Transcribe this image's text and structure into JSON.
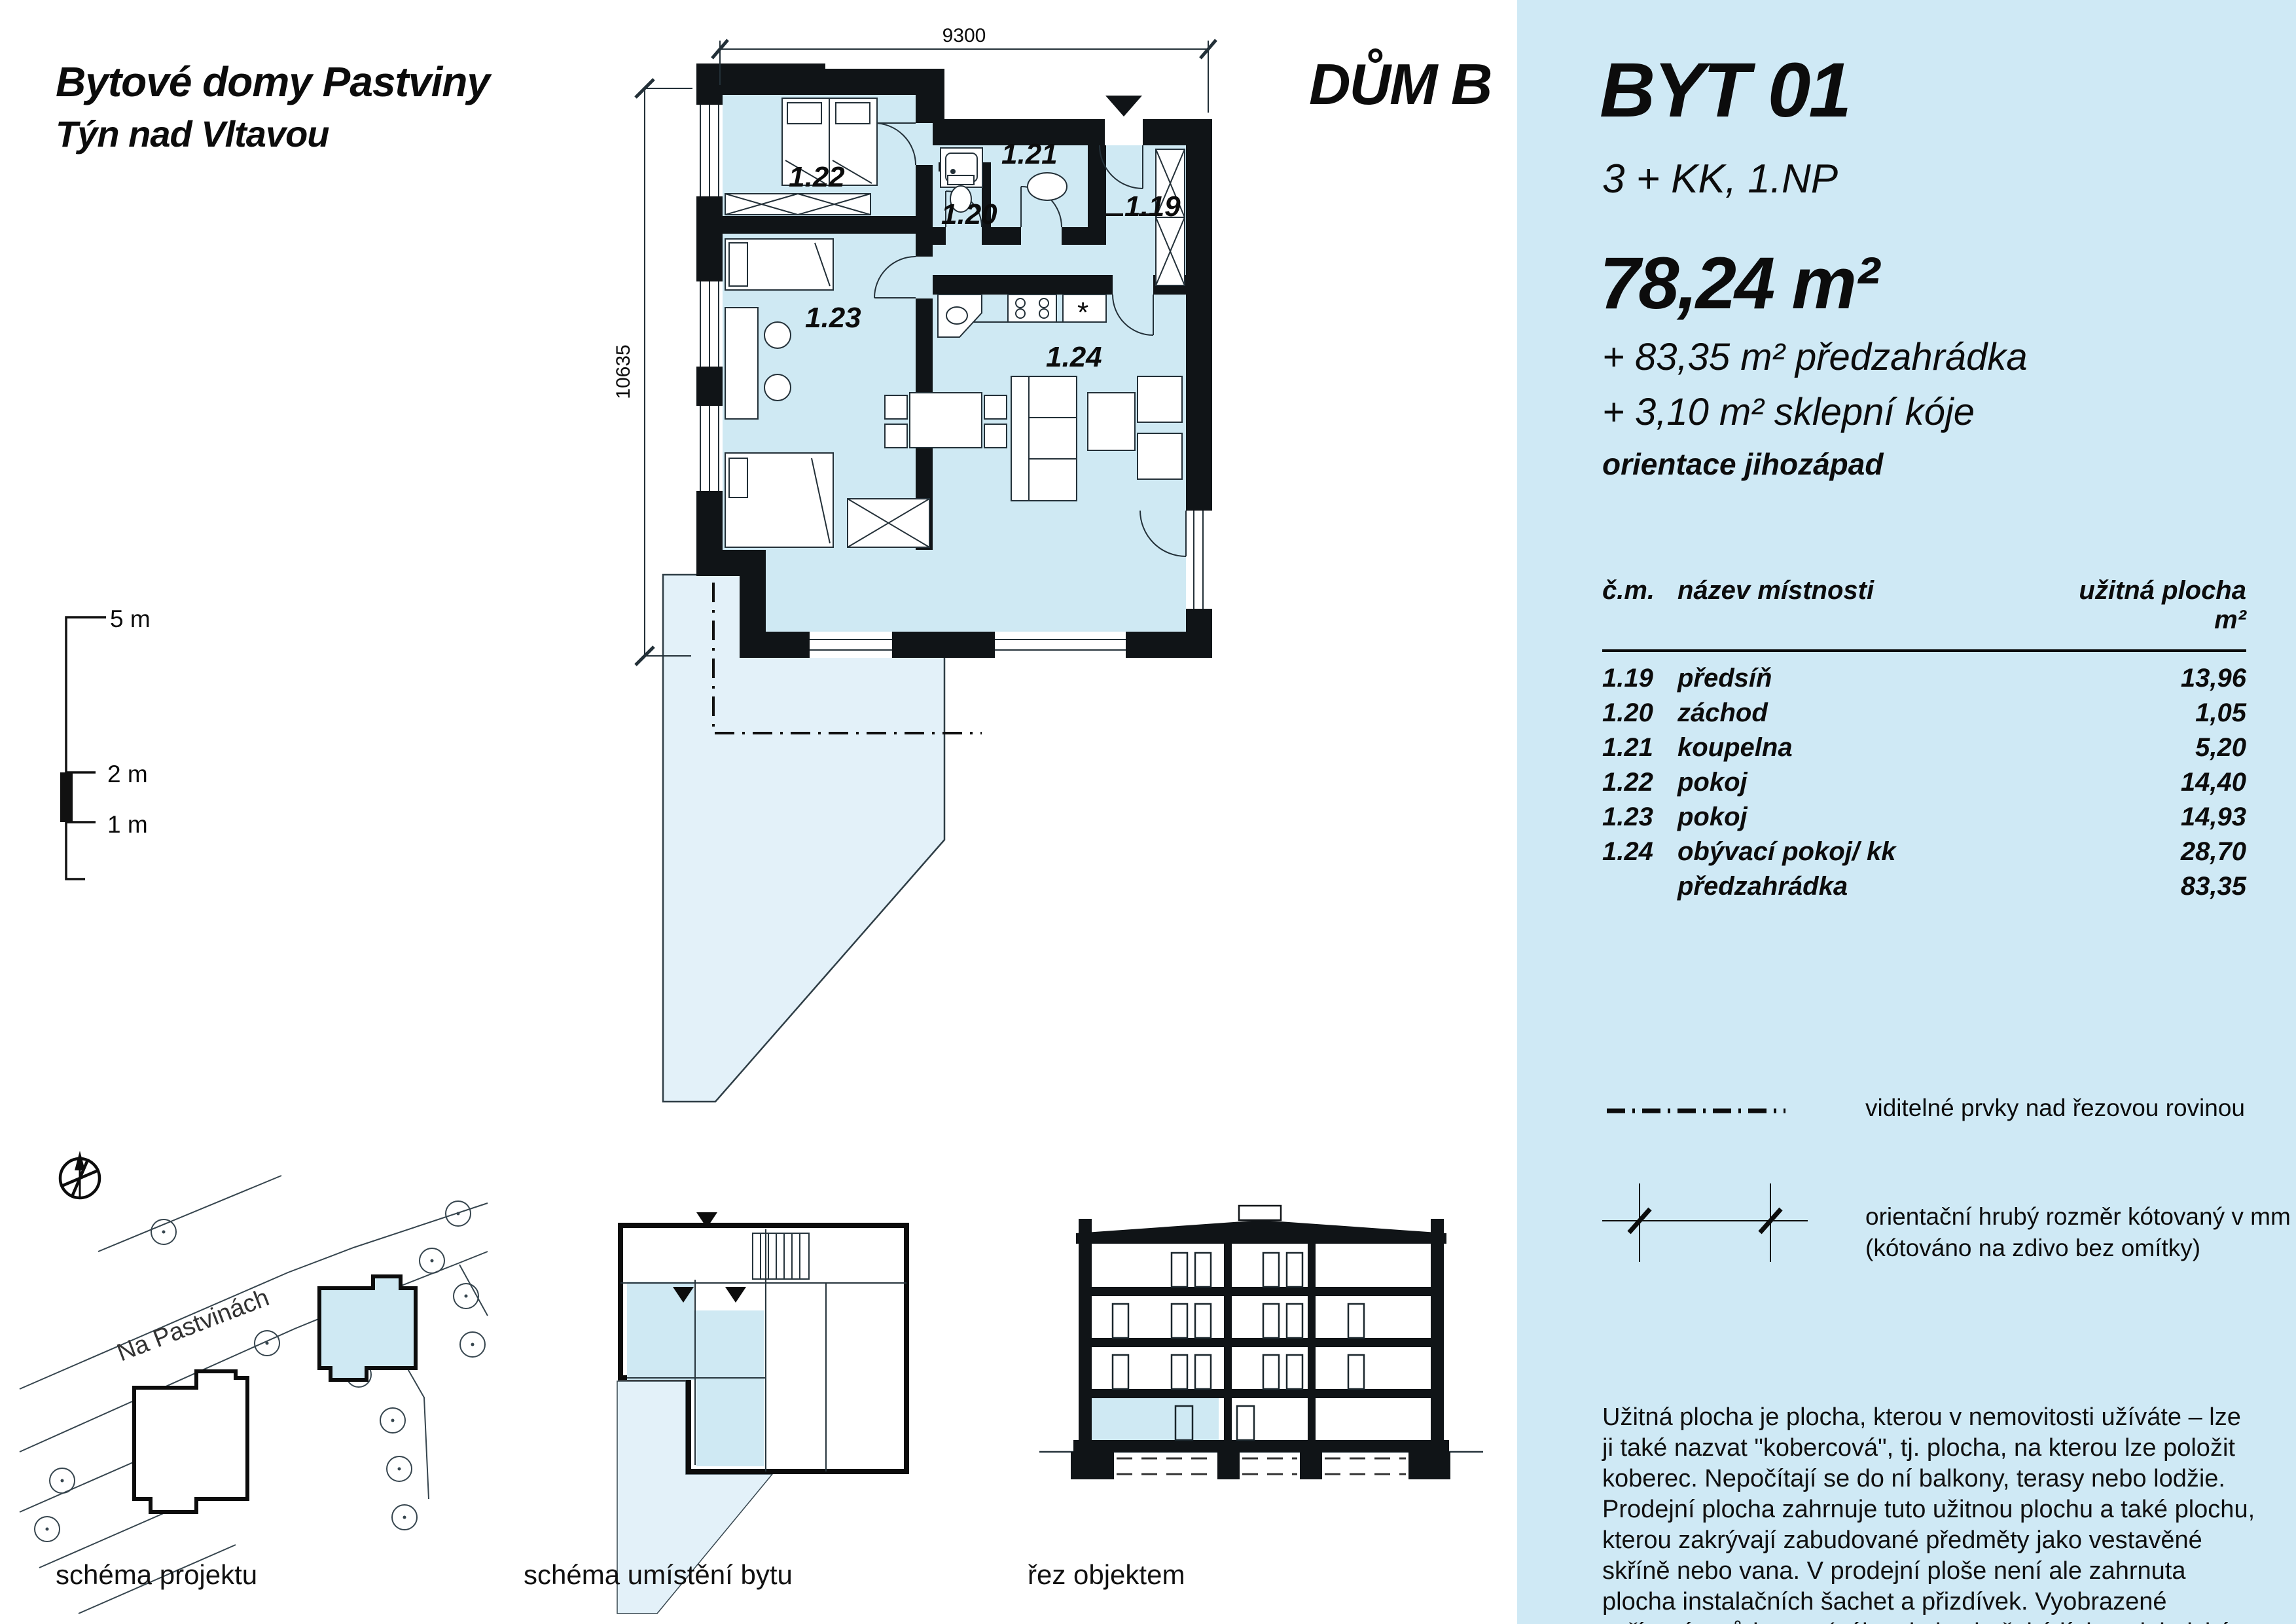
{
  "header": {
    "project_title": "Bytové domy Pastviny",
    "project_subtitle": "Týn nad Vltavou",
    "building_label": "DŮM B"
  },
  "panel": {
    "flat_id": "BYT 01",
    "flat_layout": "3 + KK, 1.NP",
    "area_main": "78,24 m²",
    "area_garden": "+ 83,35 m² předzahrádka",
    "area_cellar": "+ 3,10 m² sklepní kóje",
    "orientation": "orientace jihozápad",
    "table": {
      "headers": [
        "č.m.",
        "název místnosti",
        "užitná plocha m²"
      ],
      "rows": [
        [
          "1.19",
          "předsíň",
          "13,96"
        ],
        [
          "1.20",
          "záchod",
          "1,05"
        ],
        [
          "1.21",
          "koupelna",
          "5,20"
        ],
        [
          "1.22",
          "pokoj",
          "14,40"
        ],
        [
          "1.23",
          "pokoj",
          "14,93"
        ],
        [
          "1.24",
          "obývací pokoj/ kk",
          "28,70"
        ],
        [
          "",
          "předzahrádka",
          "83,35"
        ]
      ]
    },
    "legend": [
      {
        "label": "viditelné prvky nad řezovou rovinou"
      },
      {
        "label": "orientační hrubý rozměr kótovaný v mm",
        "label2": "(kótováno na zdivo bez omítky)"
      }
    ],
    "note": "Užitná plocha je plocha, kterou v nemovitosti užíváte – lze ji také nazvat \"kobercová\", tj. plocha, na kterou lze položit koberec. Nepočítají se do ní balkony, terasy nebo lodžie. Prodejní plocha zahrnuje tuto užitnou plochu a také plochu, kterou zakrývají zabudované předměty jako vestavěné skříně nebo vana. V prodejní ploše není ale zahrnuta plocha instalačních šachet a přizdívek. Vyobrazené zařízení v půdorysu (nábytek, kuchyňská línka, elektrické spotřebiče, atd.) není součástí dodávky."
  },
  "floor_plan": {
    "dim_width": "9300",
    "dim_height": "10635",
    "rooms": {
      "r119": "1.19",
      "r120": "1.20",
      "r121": "1.21",
      "r122": "1.22",
      "r123": "1.23",
      "r124": "1.24"
    }
  },
  "scale_bar": {
    "labels": [
      "5 m",
      "2 m",
      "1 m"
    ]
  },
  "figures": {
    "site": {
      "street": "Na Pastvinách",
      "caption": "schéma projektu"
    },
    "unit_location": {
      "caption": "schéma umístění bytu"
    },
    "section": {
      "caption": "řez objektem"
    }
  },
  "colors": {
    "panel_bg": "#cfe9f5",
    "room_fill": "#cfe9f3",
    "garden_fill": "#e3f1f9",
    "wall": "#101417",
    "line": "#233038"
  }
}
